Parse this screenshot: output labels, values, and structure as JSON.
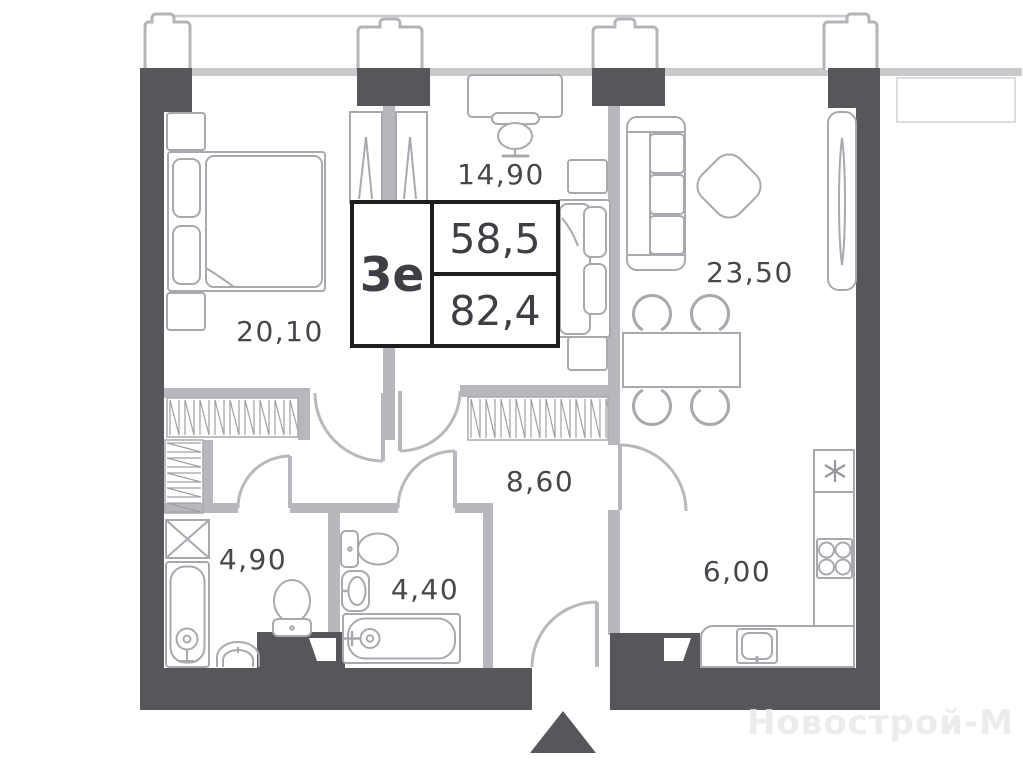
{
  "plan": {
    "info": {
      "type": "3е",
      "area_living": "58,5",
      "area_total": "82,4"
    },
    "rooms": {
      "bedroom": "20,10",
      "office": "14,90",
      "living": "23,50",
      "hall": "8,60",
      "bath1": "4,90",
      "bath2": "4,40",
      "kitchen": "6,00"
    },
    "watermark": "Новострой-М",
    "colors": {
      "wall_dark": "#56575b",
      "wall_light": "#b7b8bd",
      "furniture": "#a8a9af",
      "label_text": "#46474d",
      "info_border": "#1d1d1f"
    }
  }
}
